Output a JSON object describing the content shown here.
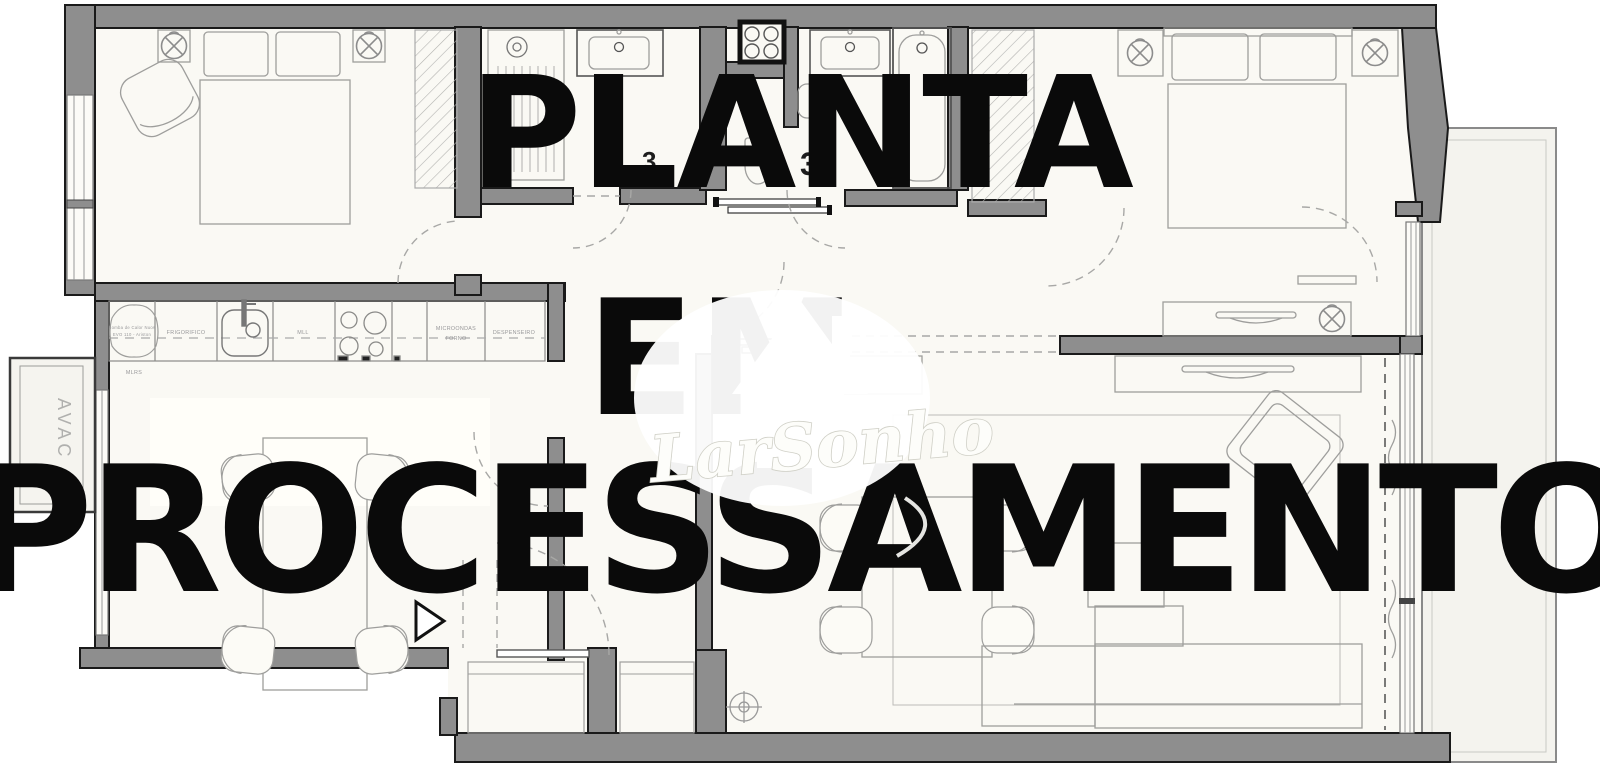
{
  "watermark": {
    "line1": "PLANTA",
    "line2": "EM",
    "line3": "PROCESSAMENTO",
    "logo_script": "LarSonho"
  },
  "labels": {
    "avac": "AVAC",
    "heat_pump_line1": "Bomba de Calor Nuos",
    "heat_pump_line2": "EVO 110 - Ariston",
    "fridge": "FRIGORIFICO",
    "dishwasher": "MLL",
    "microwave": "MICROONDAS",
    "oven": "FORNO",
    "pantry": "DESPENSEIRO",
    "laundry": "MLRS",
    "area_fragment_1": "3,",
    "area_fragment_1_sup": "2",
    "area_fragment_2": "3"
  },
  "colors": {
    "wall_fill": "#8e8e8e",
    "wall_stroke": "#1a1a1a",
    "floor": "#faf9f4",
    "balcony": "#f4f3ee",
    "furniture_line": "#9e9e9c",
    "watermark_text": "#0a0a0a",
    "logo_white": "#fdfdfa"
  }
}
